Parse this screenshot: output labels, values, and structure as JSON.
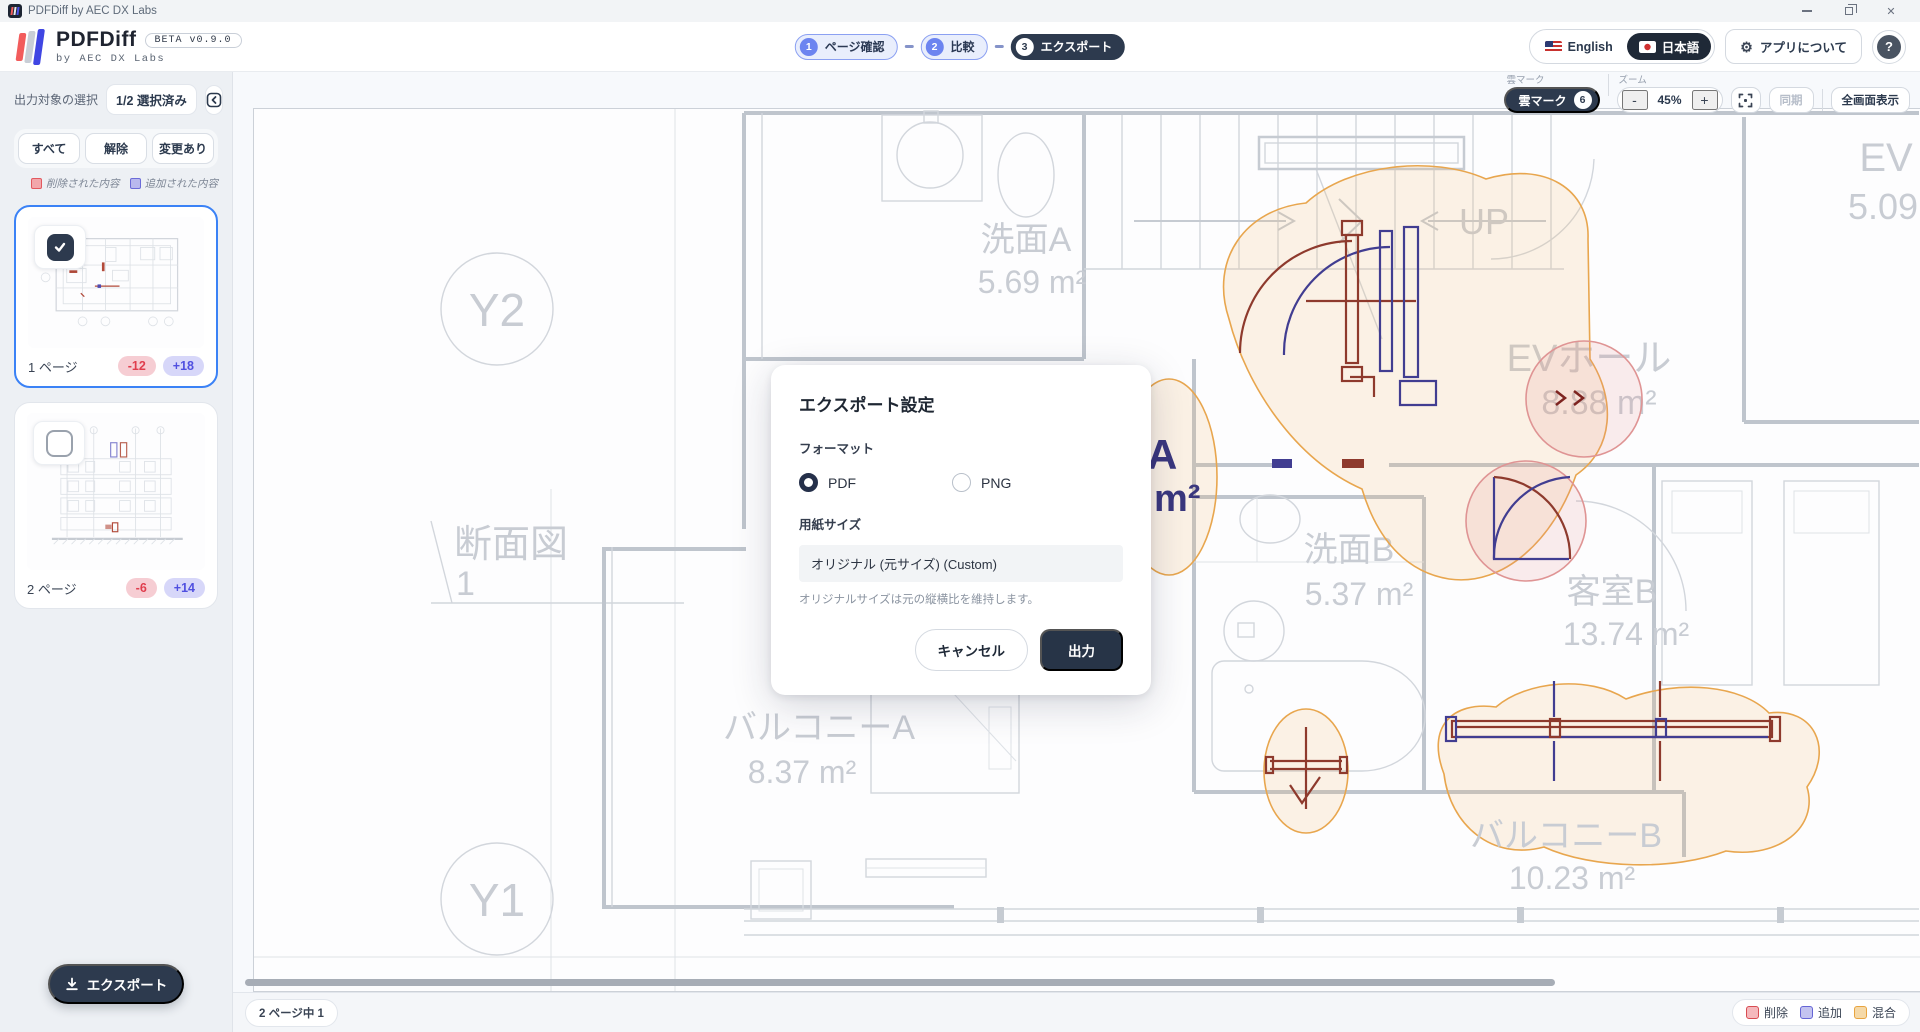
{
  "titlebar": {
    "title": "PDFDiff by AEC DX Labs"
  },
  "header": {
    "logo_title": "PDFDiff",
    "beta_badge": "BETA v0.9.0",
    "logo_subtitle": "by AEC DX Labs",
    "steps": [
      {
        "num": "1",
        "label": "ページ確認"
      },
      {
        "num": "2",
        "label": "比較"
      },
      {
        "num": "3",
        "label": "エクスポート"
      }
    ],
    "lang_english": "English",
    "lang_japanese": "日本語",
    "about_button": "アプリについて",
    "help_label": "?"
  },
  "icons": {
    "gear": "⚙",
    "close": "✕",
    "cloud_icon_note": "cloud-revision-mark"
  },
  "sidebar": {
    "title": "出力対象の選択",
    "selected_count": "1/2 選択済み",
    "filter_all": "すべて",
    "filter_clear": "解除",
    "filter_changed": "変更あり",
    "legend_removed": "削除された内容",
    "legend_added": "追加された内容",
    "pages": [
      {
        "label": "1 ページ",
        "removed": "-12",
        "added": "+18",
        "selected": true
      },
      {
        "label": "2 ページ",
        "removed": "-6",
        "added": "+14",
        "selected": false
      }
    ],
    "export_button": "エクスポート"
  },
  "toolbar": {
    "cloud_label": "雲マーク",
    "cloud_button": "雲マーク",
    "cloud_count": "6",
    "zoom_label": "ズーム",
    "zoom_out": "-",
    "zoom_value": "45%",
    "zoom_in": "+",
    "sync_button": "同期",
    "fullscreen_button": "全画面表示"
  },
  "modal": {
    "title": "エクスポート設定",
    "format_label": "フォーマット",
    "format_pdf": "PDF",
    "format_png": "PNG",
    "paper_label": "用紙サイズ",
    "paper_value": "オリジナル (元サイズ) (Custom)",
    "hint": "オリジナルサイズは元の縦横比を維持します。",
    "cancel_button": "キャンセル",
    "export_button": "出力"
  },
  "statusbar": {
    "page_indicator": "2 ページ中 1",
    "legend_removed": "削除",
    "legend_added": "追加",
    "legend_mixed": "混合"
  },
  "canvas": {
    "grid_y2": "Y2",
    "grid_y1": "Y1",
    "section_label": "断面図",
    "section_number": "1",
    "up_label": "UP",
    "rooms": {
      "senmen_a": {
        "name": "洗面A",
        "area": "5.69 m²"
      },
      "ev": {
        "name": "EV",
        "area": "5.09 m²"
      },
      "ev_hall": {
        "name": "EVホール",
        "area": "8.88 m²"
      },
      "senmen_b": {
        "name": "洗面B",
        "area": "5.37 m²"
      },
      "kyakushitsu_b": {
        "name": "客室B",
        "area": "13.74 m²"
      },
      "balcony_a": {
        "name": "バルコニーA",
        "area": "8.37 m²"
      },
      "balcony_b": {
        "name": "バルコニーB",
        "area": "10.23 m²"
      },
      "kyakushitsu_a_partial": {
        "name": "A",
        "area": "m²"
      }
    }
  },
  "colors": {
    "accent_blue": "#3b82f6",
    "dark_navy": "#2d3a4e",
    "diff_removed": "#e03e4e",
    "diff_added": "#5050e0",
    "diff_mixed": "#e8a43f"
  }
}
